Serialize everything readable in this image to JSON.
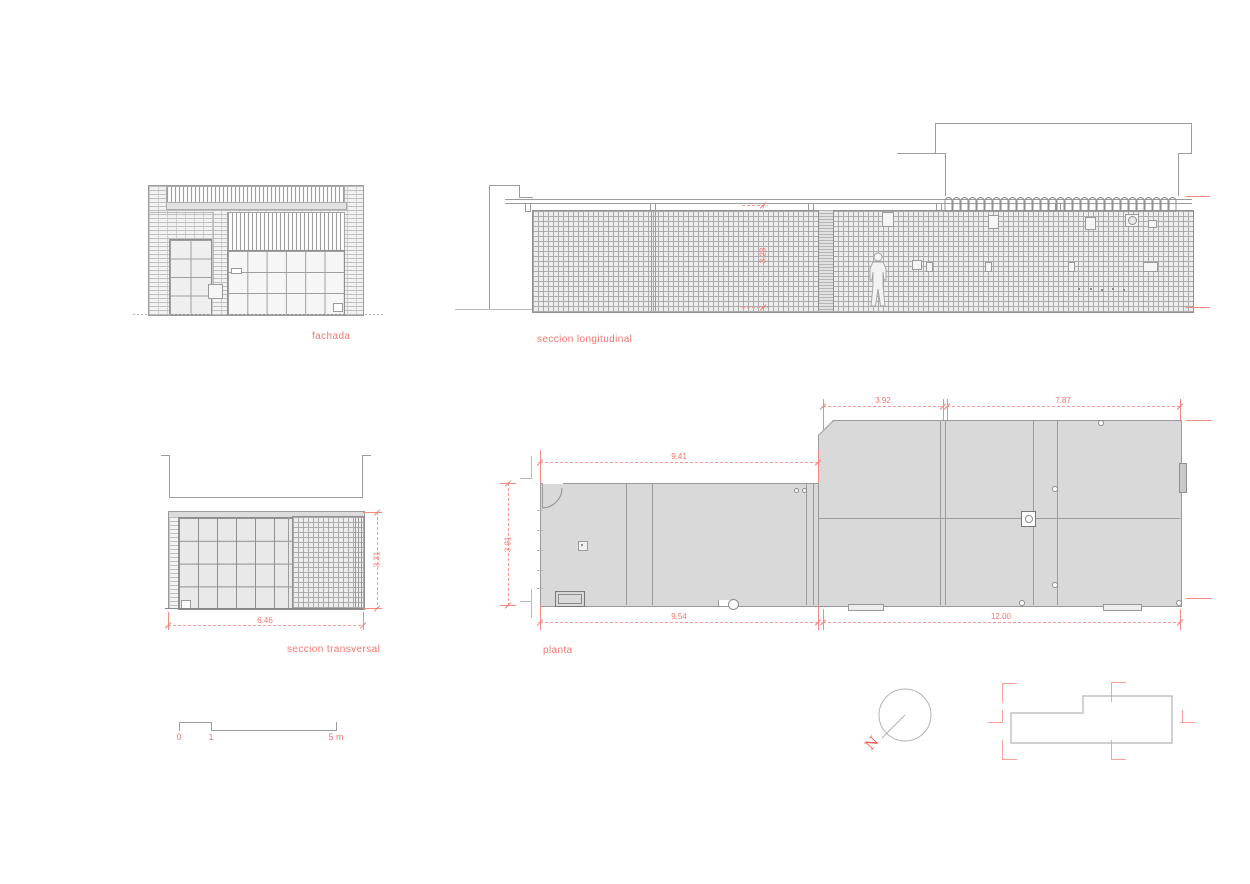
{
  "colors": {
    "accent_red": "#f4766e",
    "line_gray": "#9c9c9c",
    "fill_gray": "#d9d9d9"
  },
  "labels": {
    "fachada": "fachada",
    "seccion_longitudinal": "seccion longitudinal",
    "seccion_transversal": "seccion transversal",
    "planta": "planta"
  },
  "dimensions": {
    "long_section_height": "3.23",
    "transversal_width": "6.46",
    "transversal_height": "3.31",
    "plan_top_left": "9.41",
    "plan_top_right_a": "3.92",
    "plan_top_right_b": "7.87",
    "plan_left_height": "3.91",
    "plan_bottom_left": "9.54",
    "plan_bottom_right": "12.00"
  },
  "scale_bar": {
    "zero": "0",
    "one": "1",
    "five": "5 m"
  },
  "north": {
    "letter": "N"
  }
}
